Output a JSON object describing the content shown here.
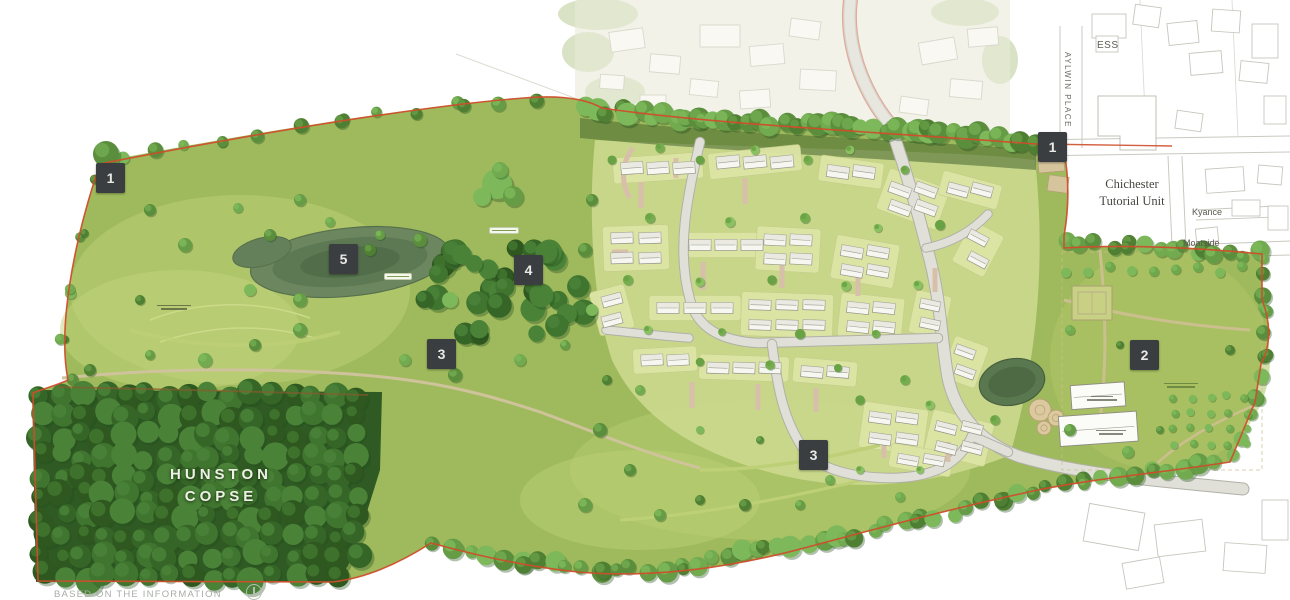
{
  "plan": {
    "badges": {
      "west": "1",
      "north": "1",
      "east": "2",
      "central": "3",
      "south": "3",
      "woodland": "4",
      "pond": "5"
    },
    "labels": {
      "hunston_line1": "HUNSTON",
      "hunston_line2": "COPSE",
      "chichester_line1": "Chichester",
      "chichester_line2": "Tutorial Unit",
      "ess": "ESS",
      "aylwin_place": "AYLWIN PLACE",
      "kyance": "Kyance",
      "moatside": "Moatside"
    },
    "caption": "BASED ON THE INFORMATION",
    "colors": {
      "boundary": "#cf4e2b",
      "badge_bg": "#3b3e40",
      "badge_text": "#e9e9e6",
      "meadow_green": "#a8c163",
      "copse_green": "#3c6a2c",
      "road_grey": "#dadad2",
      "plot_yellow_green": "#dde5a5"
    }
  }
}
